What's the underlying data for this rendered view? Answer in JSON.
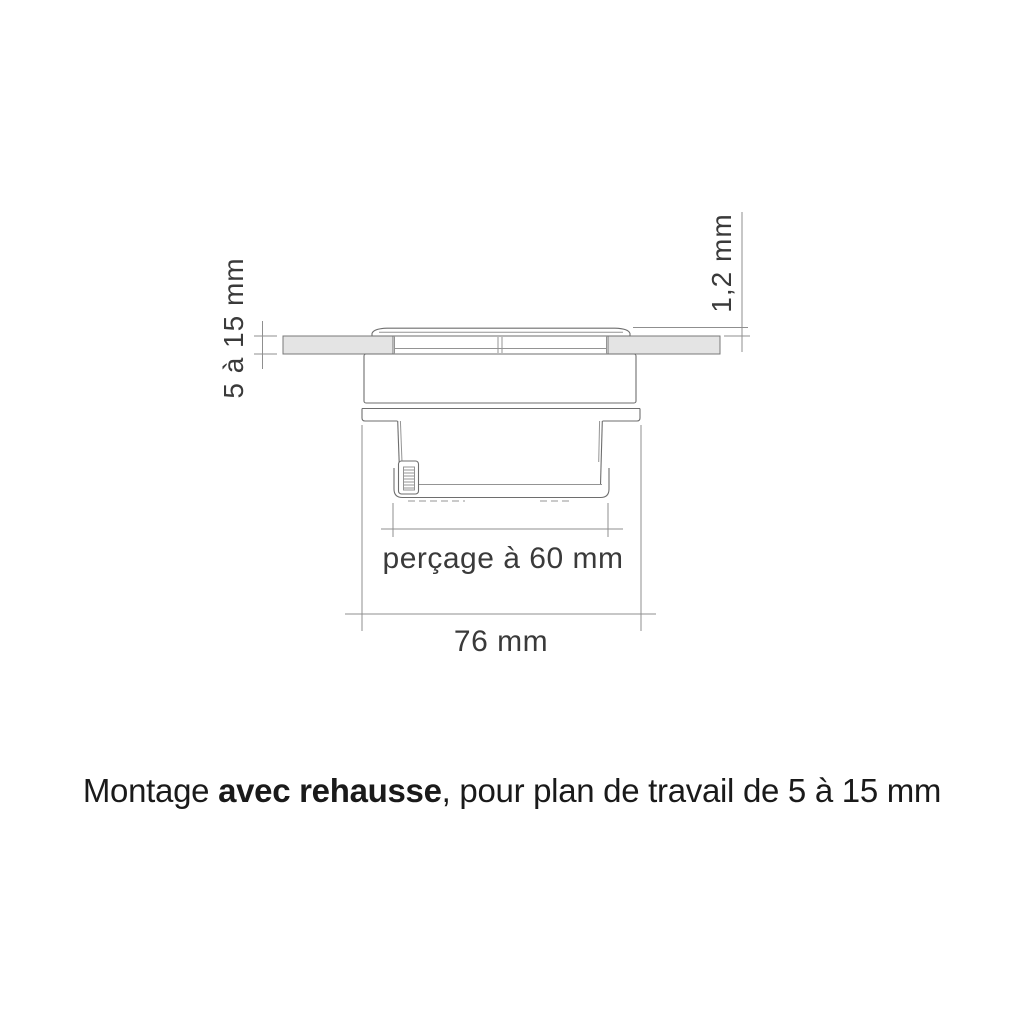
{
  "colors": {
    "line": "#6e6e6e",
    "line_thin": "#949494",
    "dim_line": "#8f8f8f",
    "worktop_fill": "#e4e4e4",
    "worktop_edge": "#787878",
    "text": "#3a3a3a",
    "caption_text": "#1a1a1a"
  },
  "dimensions": {
    "worktop_thickness_label": "5 à 15 mm",
    "cover_height_label": "1,2 mm",
    "drill_label": "perçage à 60 mm",
    "overall_width_label": "76 mm"
  },
  "caption": {
    "part1": "Montage ",
    "part2": "avec rehausse",
    "part3": ", pour plan de travail de 5 à 15 mm"
  }
}
